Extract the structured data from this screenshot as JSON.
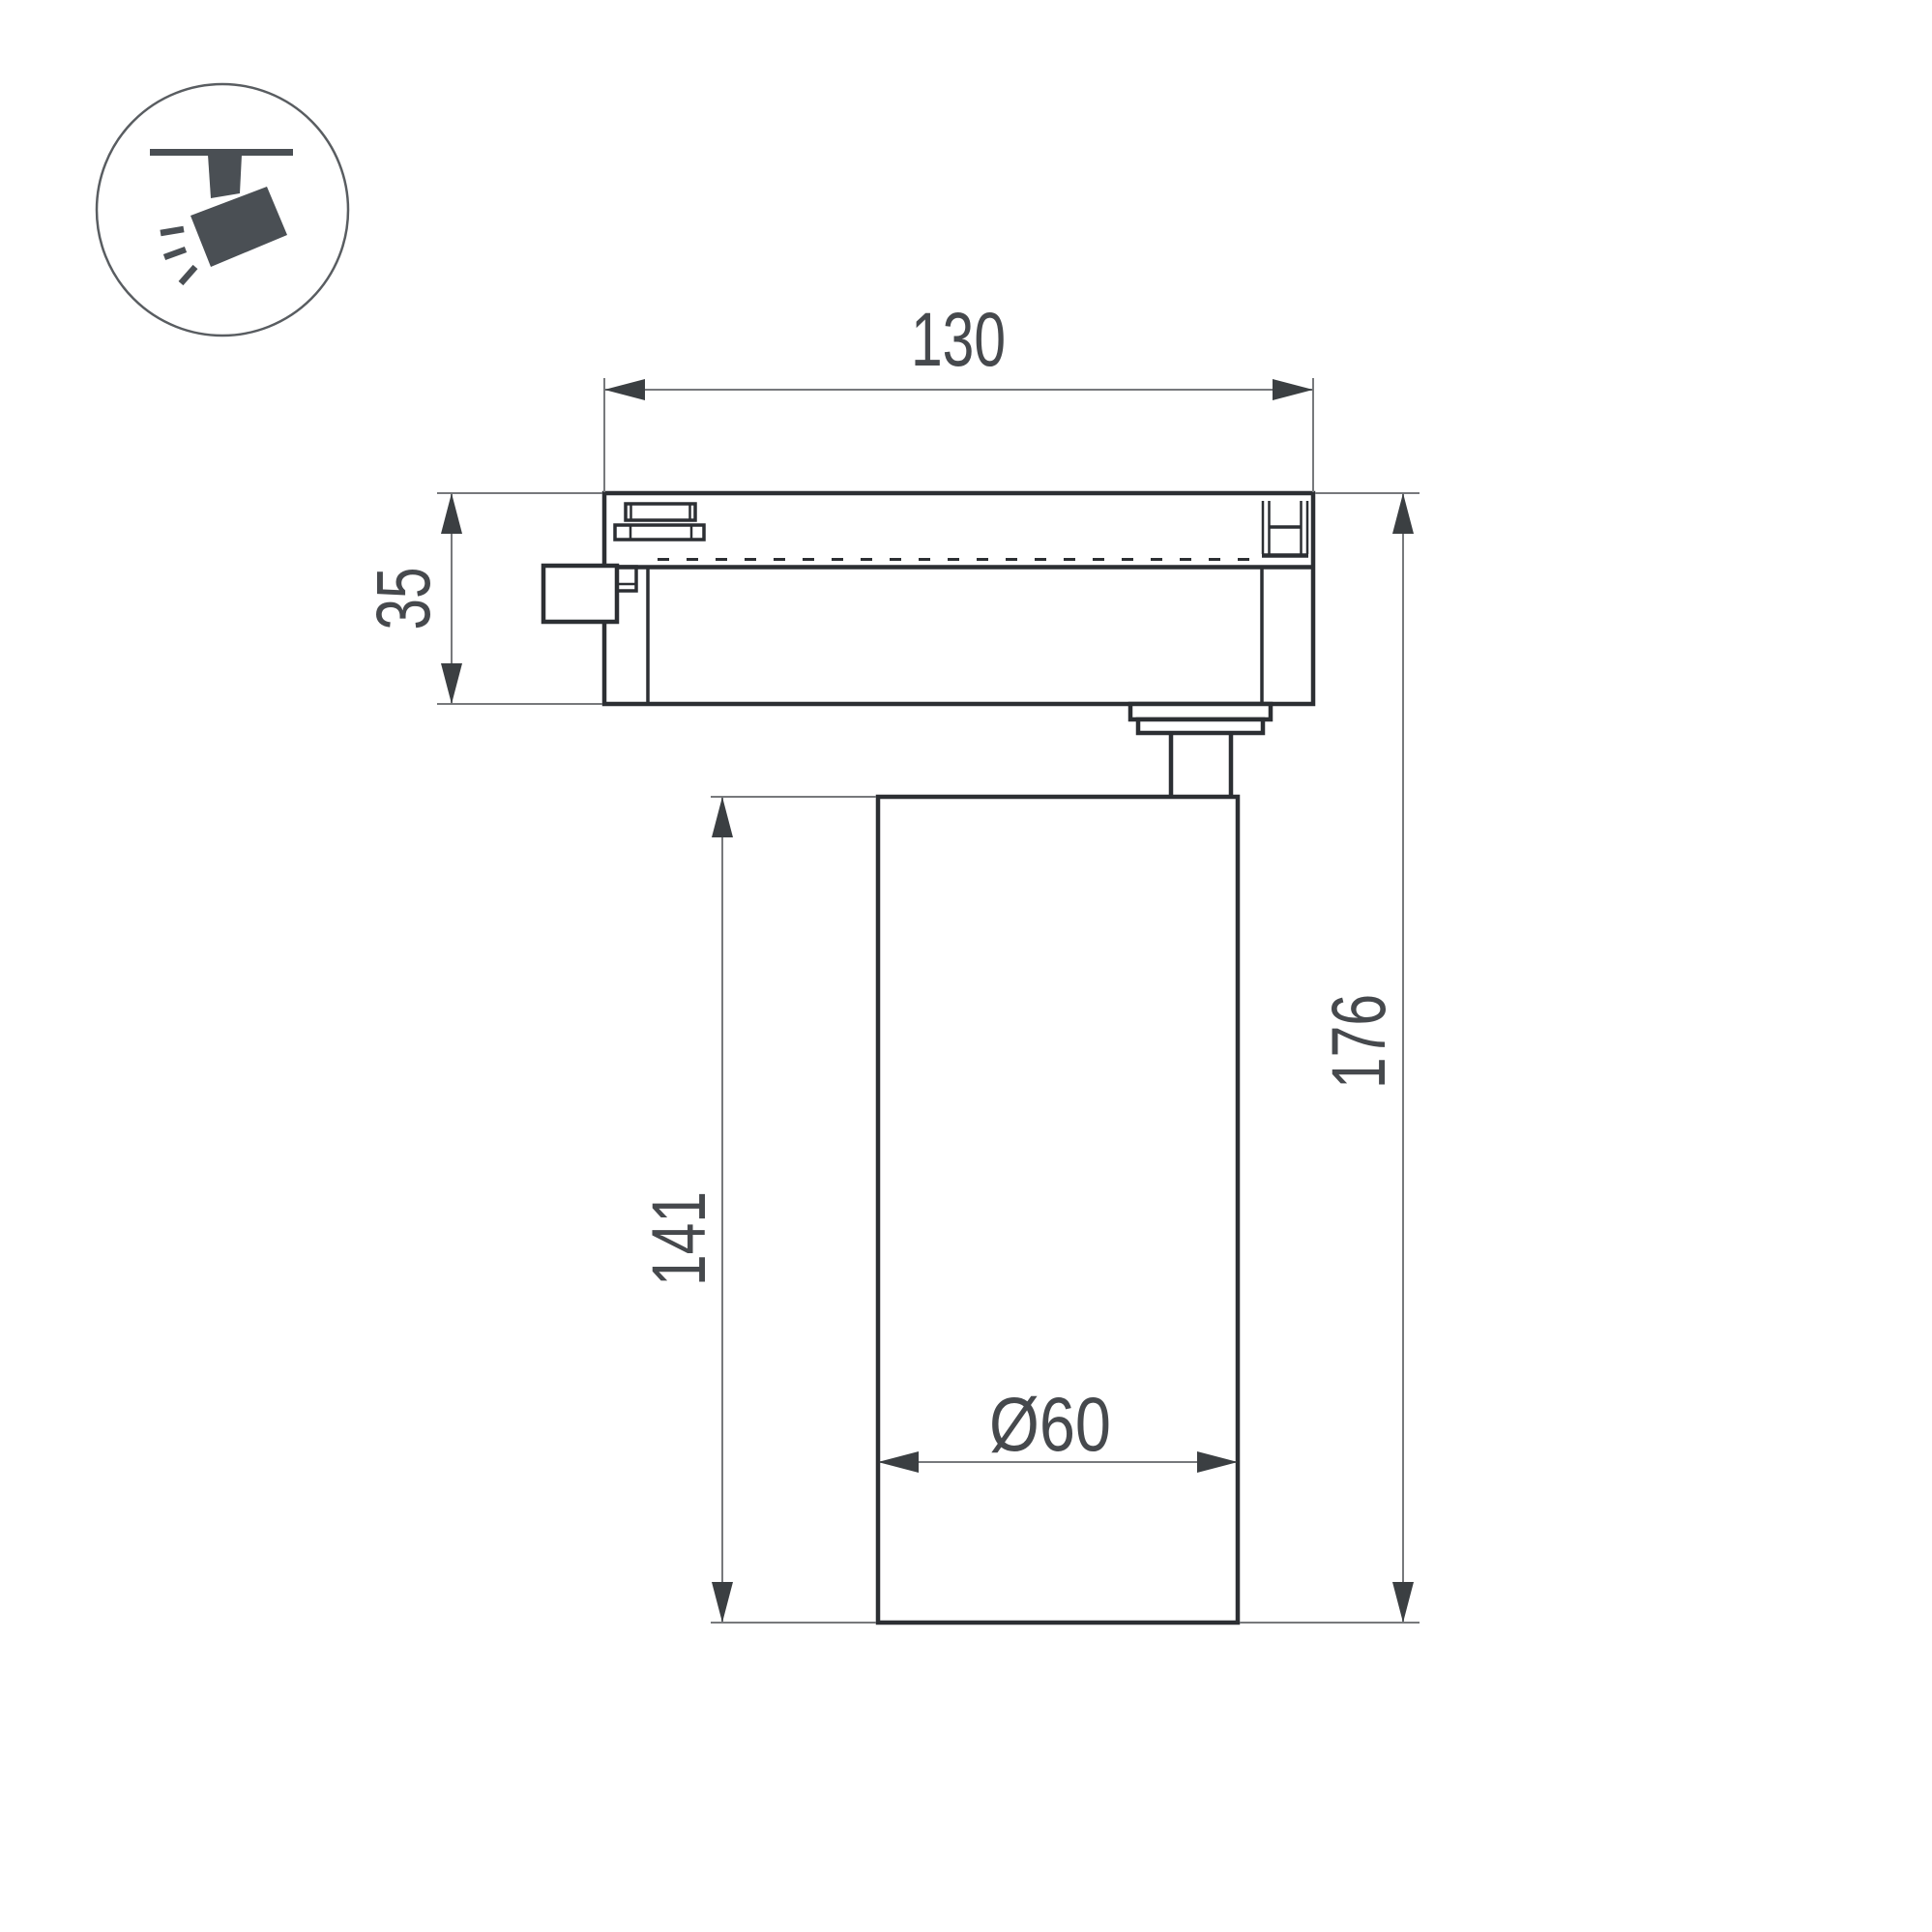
{
  "page": {
    "title": "track-spotlight-dimension-drawing",
    "background": "#ffffff"
  },
  "icon_legend": {
    "name": "track-mounted-spotlight-icon"
  },
  "dimensions": {
    "track_width": "130",
    "adapter_height": "35",
    "body_length": "141",
    "total_height": "176",
    "body_diameter": "Ø60"
  },
  "colors": {
    "outline": "#2c2f33",
    "dim_line": "#77797c",
    "arrow": "#3b3f42",
    "text": "#46494d",
    "icon": "#4a4f54",
    "circle_stroke": "#595d61"
  }
}
